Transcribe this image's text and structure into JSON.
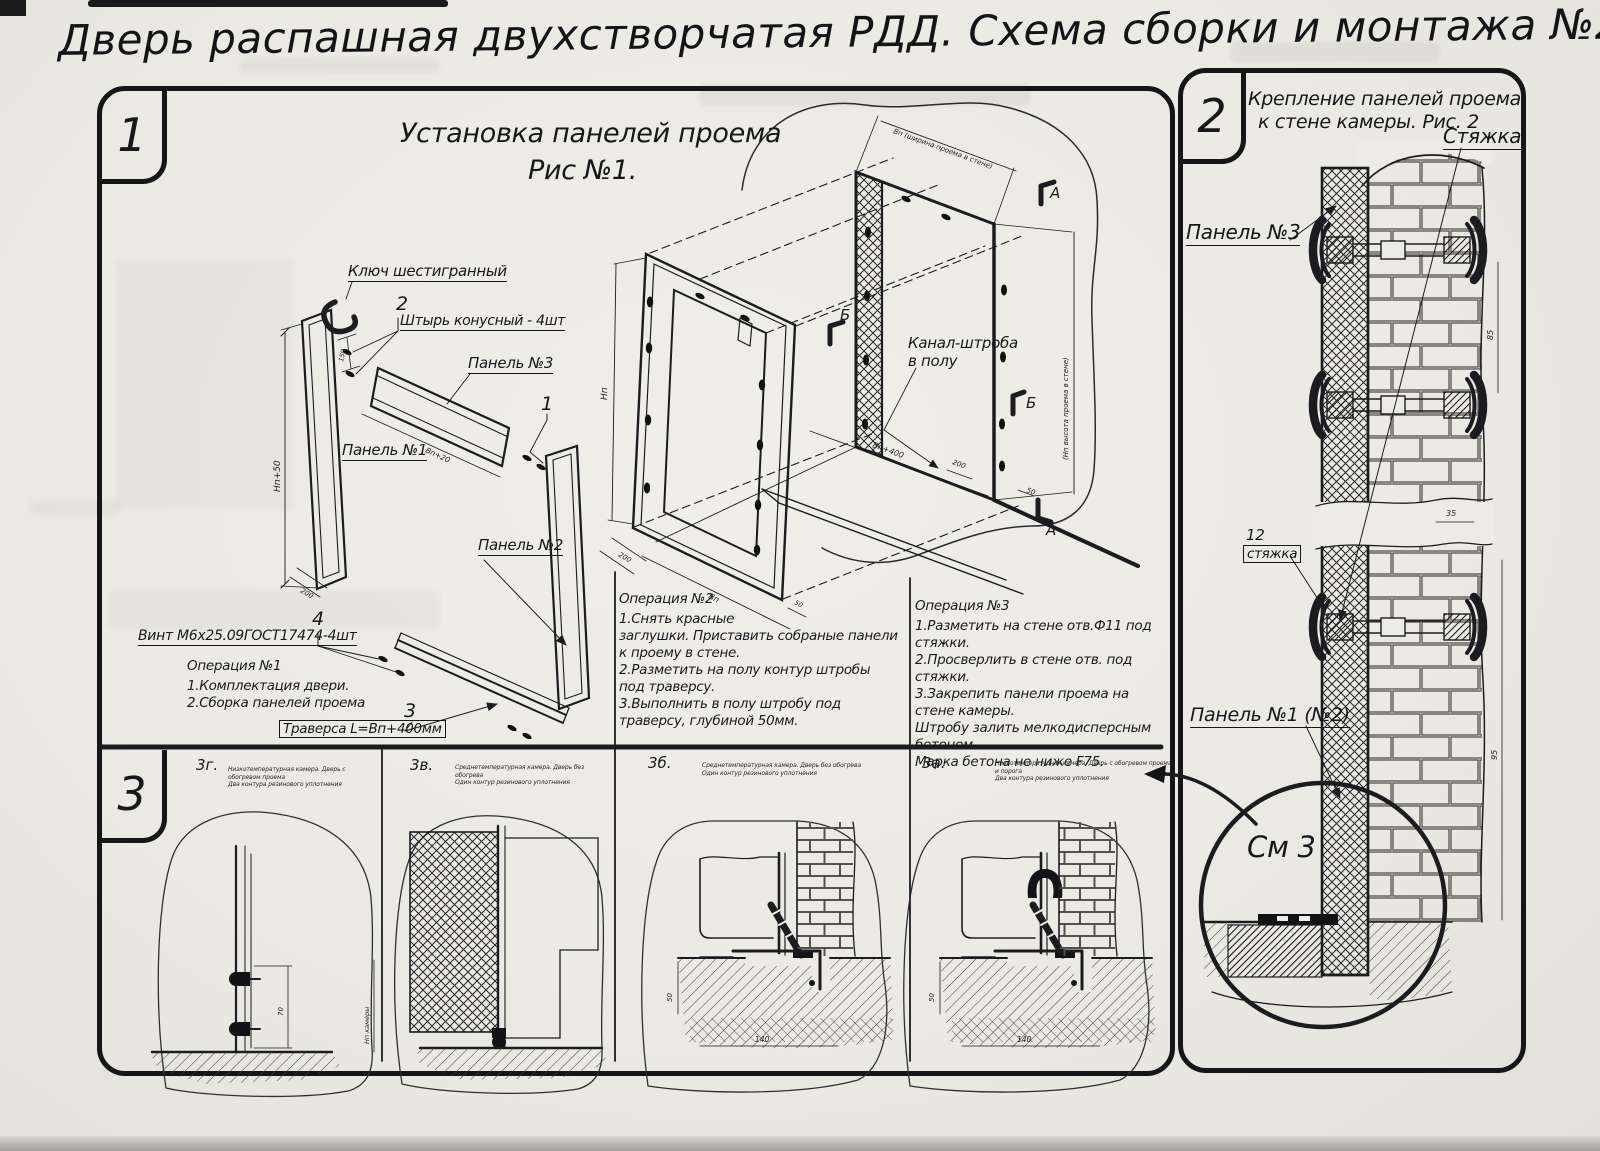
{
  "page": {
    "title": "Дверь распашная двухстворчатая РДД.  Схема сборки и монтажа №2"
  },
  "fig1": {
    "number": "1",
    "title": "Установка панелей проема",
    "subtitle": "Рис №1.",
    "labels": {
      "hex_key": "Ключ шестигранный",
      "pin_num": "2",
      "pin": "Штырь конусный - 4шт",
      "panel3": "Панель №3",
      "num1": "1",
      "panel1": "Панель №1",
      "panel2": "Панель №2",
      "screw_num": "4",
      "screw": "Винт М6х25.09ГОСТ17474-4шт",
      "trav_num": "3",
      "traverse": "Траверса  L=Вп+400мм",
      "channel1": "Канал-штроба",
      "channel2": "в полу"
    },
    "op1": {
      "title": "Операция №1",
      "lines": [
        "1.Комплектация двери.",
        "2.Сборка панелей проема"
      ]
    },
    "op2": {
      "title": "Операция №2",
      "lines": [
        "1.Снять красные",
        "заглушки. Приставить собраные панели",
        "к проему в стене.",
        "2.Разметить на полу контур штробы",
        "под траверсу.",
        "3.Выполнить в полу штробу под",
        "траверсу, глубиной 50мм."
      ]
    },
    "op3": {
      "title": "Операция №3",
      "lines": [
        "1.Разметить на стене отв.Ф11 под",
        "стяжки.",
        "2.Просверлить в стене отв.  под",
        "стяжки.",
        "3.Закрепить панели проема на стене камеры.",
        "Штробу залить мелкодисперсным бетоном",
        "Марка бетона не ниже  F75."
      ]
    },
    "dims": {
      "np50": "Нп+50",
      "d150": "150",
      "d200": "200",
      "vp20": "Вп+20",
      "np": "Нп",
      "vp": "Вп",
      "d50": "50",
      "vp400": "Вп+400",
      "wall_w": "Вп (ширина проема в стене)",
      "wall_h": "(Нп высота проема в стене)",
      "a": "А",
      "b": "Б"
    }
  },
  "fig2": {
    "number": "2",
    "title1": "Крепление панелей проема",
    "title2": "к стене камеры. Рис. 2",
    "labels": {
      "tie": "Стяжка",
      "panel3": "Панель №3",
      "pos12": "12",
      "tie2": "стяжка",
      "panel12": "Панель №1 (№2)",
      "see3": "См 3"
    },
    "dims": {
      "d35": "35",
      "d85": "85",
      "d95": "95"
    }
  },
  "fig3": {
    "number": "3",
    "panels": [
      {
        "code": "3г.",
        "cap1": "Низкотемпературная камера. Дверь с обогревом проема",
        "cap2": "Два контура резинового уплотнения"
      },
      {
        "code": "3в.",
        "cap1": "Среднетемпературная камера. Дверь без обогрева",
        "cap2": "Один контур резинового уплотнения"
      },
      {
        "code": "3б.",
        "cap1": "Среднетемпературная камера. Дверь без обогрева",
        "cap2": "Один контур резинового уплотнения"
      },
      {
        "code": "3а.",
        "cap1": "Низкотемпературная камера. Дверь с обогревом проема и порога",
        "cap2": "Два контура резинового уплотнения"
      }
    ],
    "dims": {
      "d70": "70",
      "np_cam": "Нп камеры",
      "d50": "50",
      "d140": "140"
    }
  }
}
